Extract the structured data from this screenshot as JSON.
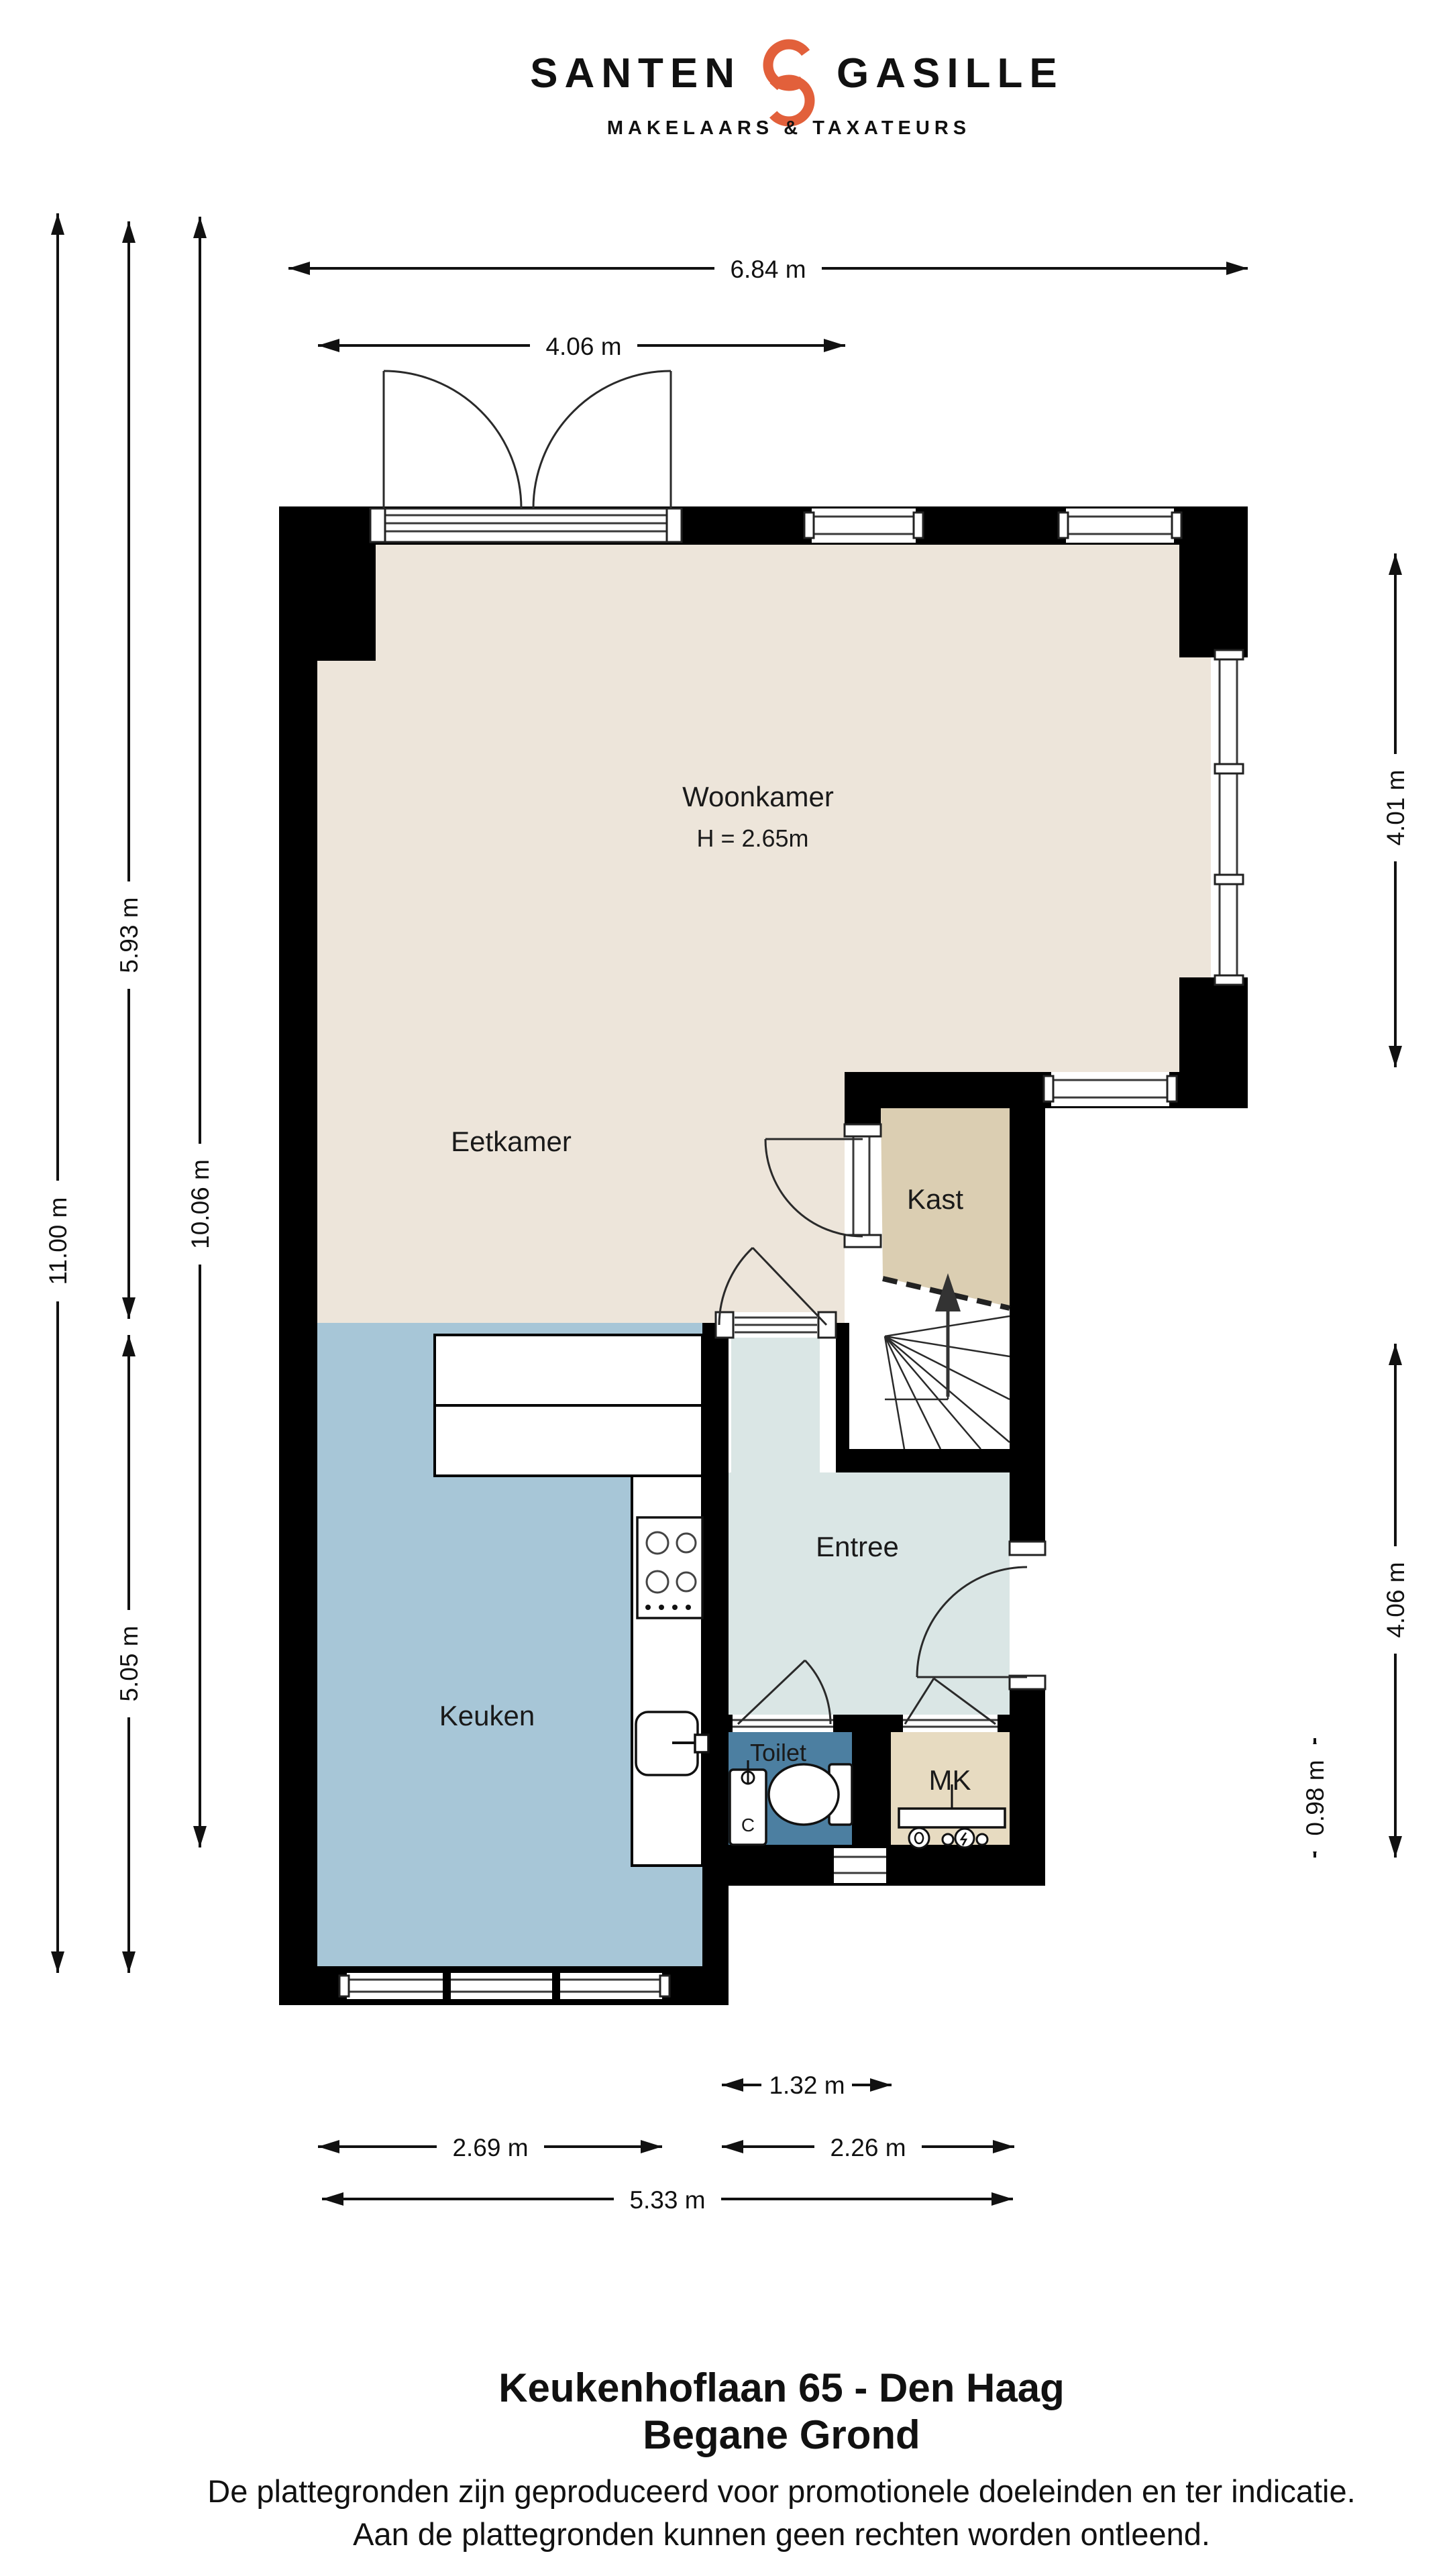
{
  "logo": {
    "brand_left": "SANTEN",
    "brand_right": "GASILLE",
    "tagline": "MAKELAARS & TAXATEURS",
    "navy": "#1F2A54",
    "orange": "#E2603B"
  },
  "floor_plan": {
    "colors": {
      "wall": "#000000",
      "dim": "#111111",
      "floor_living": "#EDE5DA",
      "floor_kast": "#DBCEB2",
      "floor_kitchen": "#A7C6D7",
      "floor_entree": "#DAE6E5",
      "floor_toilet": "#4C7FA1",
      "floor_mk": "#E7DBC1"
    },
    "room_labels": {
      "woonkamer": "Woonkamer",
      "woonkamer_height": "H = 2.65m",
      "eetkamer": "Eetkamer",
      "kast": "Kast",
      "entree": "Entree",
      "keuken": "Keuken",
      "toilet": "Toilet",
      "mk": "MK",
      "fontein": "C"
    },
    "dimensions": {
      "top_width": "6.84 m",
      "top_door_width": "4.06 m",
      "left_total": "11.00 m",
      "left_upper": "5.93 m",
      "left_inner": "10.06 m",
      "left_lower": "5.05 m",
      "right_upper": "4.01 m",
      "right_lower": "4.06 m",
      "right_small": "0.98 m",
      "bottom_hall": "1.32 m",
      "bottom_kitchen": "2.69 m",
      "bottom_entree": "2.26 m",
      "bottom_total": "5.33 m"
    }
  },
  "footer": {
    "title": "Keukenhoflaan 65 - Den Haag",
    "subtitle": "Begane Grond",
    "disclaimer_line1": "De plattegronden zijn geproduceerd voor promotionele doeleinden en ter indicatie.",
    "disclaimer_line2": "Aan de plattegronden kunnen geen rechten worden ontleend."
  }
}
